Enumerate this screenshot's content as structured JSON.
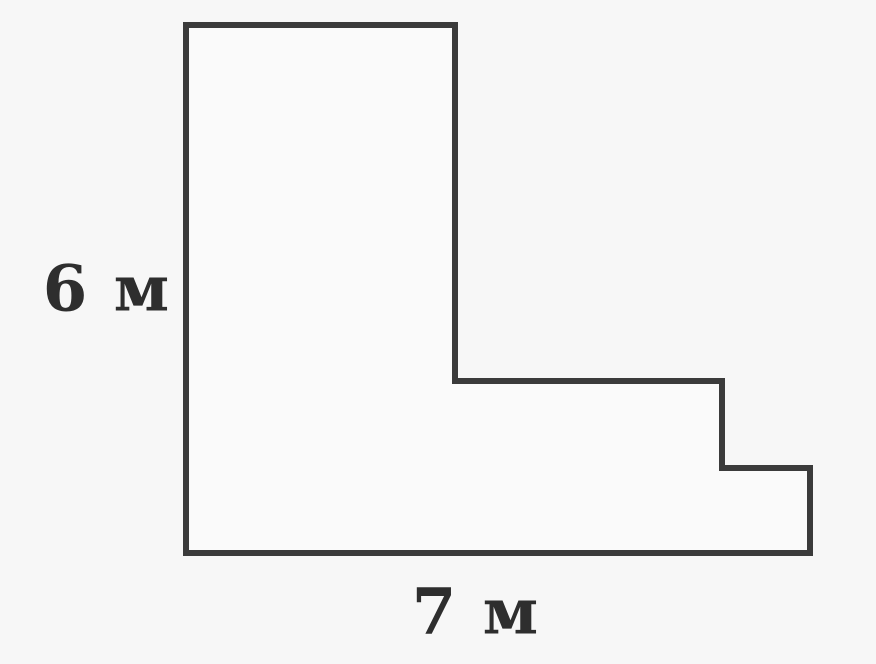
{
  "canvas": {
    "width_px": 876,
    "height_px": 664,
    "background_color": "#f7f7f7"
  },
  "figure": {
    "type": "rectilinear-staircase-polygon",
    "description": "L-shaped polygon with two steps on the lower right side",
    "polygon_points": "186,25 455,25 455,381 722,381 722,468 810,468 810,553 186,553",
    "stroke_color": "#3b3b3b",
    "stroke_width": "6",
    "fill_color": "#fafafa"
  },
  "labels": {
    "height": {
      "text": "6 м",
      "value": 6,
      "unit": "м",
      "side": "left"
    },
    "width": {
      "text": "7 м",
      "value": 7,
      "unit": "м",
      "side": "bottom"
    }
  }
}
